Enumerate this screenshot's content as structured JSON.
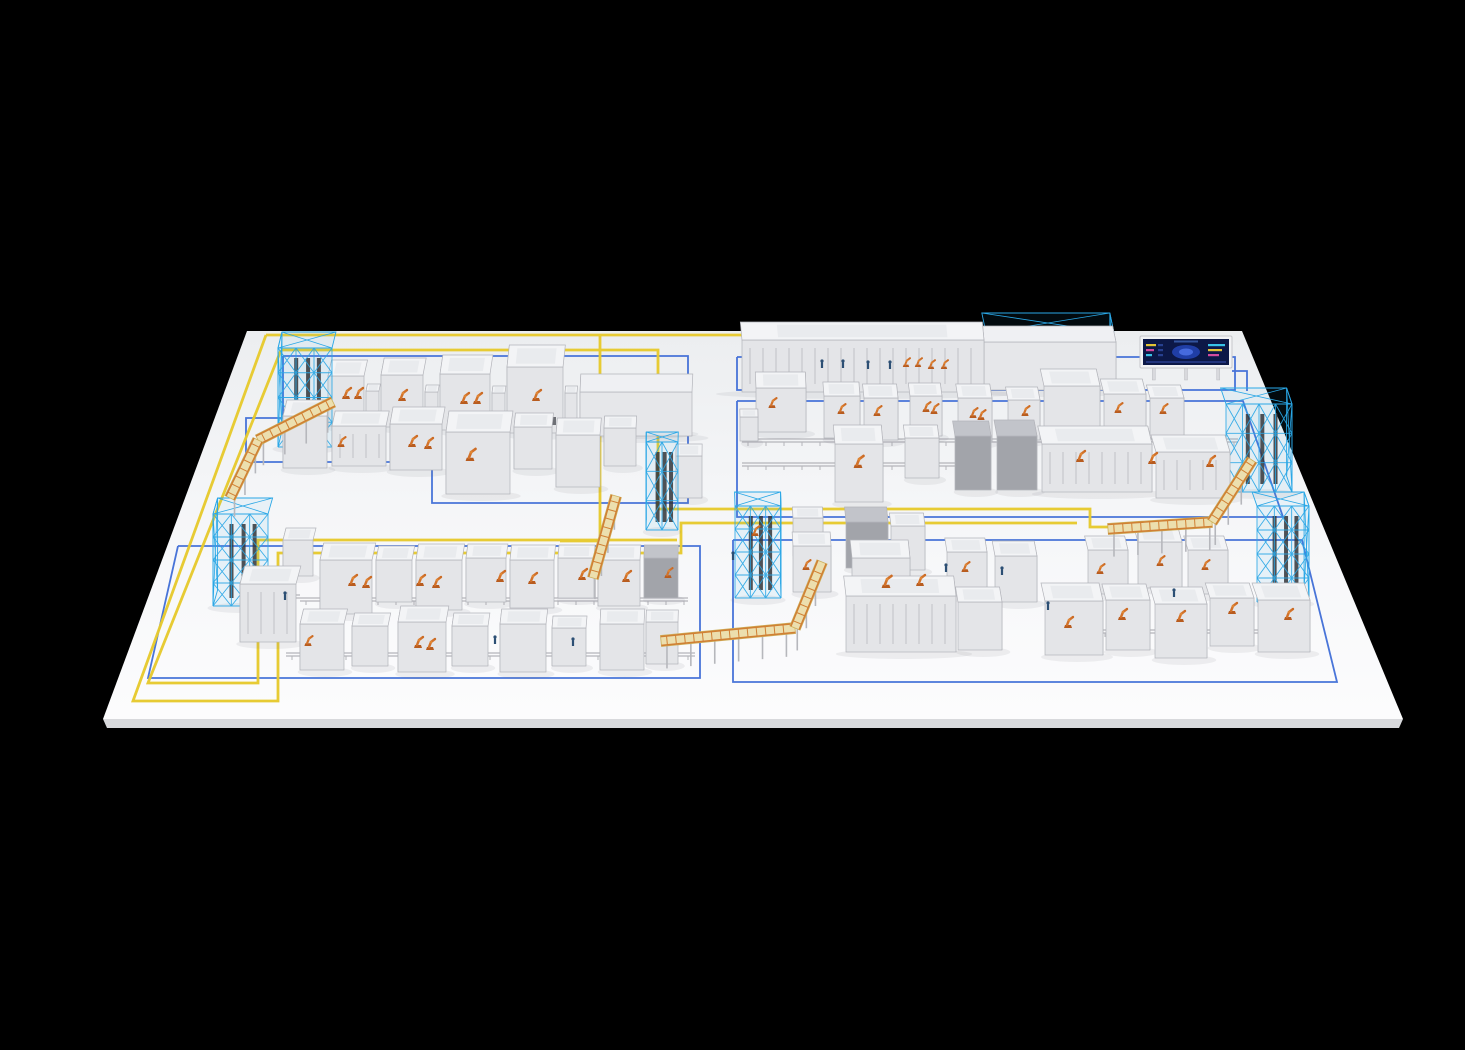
{
  "palette": {
    "background": "#000000",
    "floor_top": "#eceef0",
    "floor_mid": "#f5f6f8",
    "floor_bottom": "#fcfcfd",
    "floor_slab_edge": "#d8d9dc",
    "zone_line_blue": "#3a69d6",
    "route_line_yellow": "#e7ca2e",
    "rack_wireframe_blue": "#2aa7e6",
    "rack_core_dark": "#33353a",
    "robot_orange": "#d2722a",
    "robot_orange_dark": "#b85c1f",
    "worker_blue": "#2c4f74",
    "machine_top": "#f3f4f6",
    "machine_front": "#e4e5e8",
    "machine_side": "#cbccd1",
    "machine_stroke": "#b3b4ba",
    "machine_interior": "#e9ebee",
    "dark_top": "#c2c4ca",
    "dark_front": "#a2a4aa",
    "dark_side": "#8e9096",
    "vent_dark": "#6d6f75",
    "conveyor_deck": "#ecdfae",
    "conveyor_deck_edge": "#cdb05a",
    "conveyor_rail": "#d08034",
    "conveyor_leg": "#b6b7bc",
    "ground_rail": "#b4b5ba",
    "shadow": "rgba(120,122,128,0.10)",
    "dashboard_frame": "#f2f3f5",
    "dashboard_frame_stroke": "#c6c7cb",
    "dashboard_screen": "#0c1847",
    "dashboard_glow": "#2243b0",
    "dashboard_glow2": "#4a6fe3",
    "dashboard_bar1": "#e3c435",
    "dashboard_bar2": "#38c3e8",
    "dashboard_bar3": "#d24a9e"
  },
  "floor": {
    "corners": [
      [
        247,
        331
      ],
      [
        1242,
        331
      ],
      [
        1403,
        719
      ],
      [
        103,
        719
      ]
    ],
    "slab": [
      [
        103,
        719
      ],
      [
        1403,
        719
      ],
      [
        1399,
        728
      ],
      [
        107,
        728
      ]
    ]
  },
  "zones": [
    {
      "points": [
        [
          283,
          356
        ],
        [
          688,
          356
        ],
        [
          688,
          503
        ],
        [
          432,
          503
        ],
        [
          432,
          462
        ],
        [
          246,
          462
        ],
        [
          246,
          418
        ],
        [
          283,
          418
        ],
        [
          283,
          356
        ]
      ]
    },
    {
      "points": [
        [
          737,
          357
        ],
        [
          1235,
          357
        ],
        [
          1235,
          390
        ],
        [
          737,
          390
        ],
        [
          737,
          357
        ]
      ]
    },
    {
      "points": [
        [
          737,
          401
        ],
        [
          1243,
          401
        ],
        [
          1283,
          517
        ],
        [
          737,
          517
        ],
        [
          737,
          401
        ]
      ]
    },
    {
      "points": [
        [
          733,
          540
        ],
        [
          1302,
          540
        ],
        [
          1337,
          682
        ],
        [
          733,
          682
        ],
        [
          733,
          540
        ]
      ]
    },
    {
      "points": [
        [
          178,
          546
        ],
        [
          700,
          546
        ],
        [
          700,
          678
        ],
        [
          148,
          678
        ],
        [
          178,
          546
        ]
      ]
    }
  ],
  "zone_connector": [
    [
      1232,
      371
    ],
    [
      1247,
      371
    ],
    [
      1247,
      391
    ]
  ],
  "routes": [
    {
      "points": [
        [
          266,
          335
        ],
        [
          934,
          335
        ]
      ]
    },
    {
      "points": [
        [
          281,
          350
        ],
        [
          658,
          350
        ],
        [
          658,
          509
        ],
        [
          692,
          509
        ],
        [
          1090,
          509
        ],
        [
          1090,
          527
        ],
        [
          1205,
          527
        ]
      ]
    },
    {
      "points": [
        [
          600,
          335
        ],
        [
          600,
          541
        ],
        [
          560,
          541
        ]
      ]
    },
    {
      "points": [
        [
          266,
          335
        ],
        [
          133,
          701
        ],
        [
          278,
          701
        ],
        [
          278,
          553
        ],
        [
          681,
          553
        ],
        [
          681,
          523
        ],
        [
          1077,
          523
        ]
      ]
    },
    {
      "points": [
        [
          281,
          350
        ],
        [
          148,
          683
        ],
        [
          258,
          683
        ],
        [
          258,
          540
        ],
        [
          677,
          540
        ]
      ]
    }
  ],
  "ground_rails": [
    [
      742,
      441,
      1238,
      441
    ],
    [
      742,
      465,
      955,
      465
    ],
    [
      300,
      600,
      688,
      600
    ],
    [
      286,
      655,
      695,
      655
    ],
    [
      1045,
      632,
      1300,
      632
    ],
    [
      265,
      597,
      300,
      597
    ]
  ],
  "machines": [
    [
      328,
      426,
      36,
      50,
      16,
      0
    ],
    [
      366,
      419,
      13,
      28,
      7,
      0
    ],
    [
      381,
      427,
      42,
      52,
      17,
      0
    ],
    [
      425,
      420,
      13,
      28,
      7,
      0
    ],
    [
      440,
      430,
      50,
      56,
      19,
      0
    ],
    [
      492,
      423,
      13,
      30,
      7,
      0
    ],
    [
      507,
      433,
      56,
      66,
      22,
      3
    ],
    [
      565,
      423,
      12,
      30,
      7,
      0
    ],
    [
      580,
      436,
      112,
      44,
      18,
      4
    ],
    [
      283,
      468,
      44,
      52,
      16,
      0
    ],
    [
      332,
      466,
      54,
      40,
      15,
      2
    ],
    [
      390,
      470,
      52,
      46,
      17,
      0
    ],
    [
      446,
      494,
      64,
      62,
      21,
      0
    ],
    [
      514,
      469,
      38,
      42,
      14,
      0
    ],
    [
      556,
      487,
      44,
      52,
      17,
      0
    ],
    [
      604,
      466,
      32,
      38,
      12,
      0
    ],
    [
      676,
      498,
      26,
      42,
      12,
      0
    ],
    [
      742,
      392,
      242,
      52,
      18,
      2
    ],
    [
      984,
      390,
      132,
      48,
      16,
      4
    ],
    [
      756,
      432,
      50,
      44,
      16,
      0
    ],
    [
      740,
      441,
      18,
      24,
      8,
      0
    ],
    [
      824,
      438,
      36,
      42,
      14,
      0
    ],
    [
      864,
      440,
      34,
      42,
      14,
      0
    ],
    [
      910,
      436,
      32,
      40,
      13,
      0
    ],
    [
      958,
      442,
      34,
      44,
      14,
      0
    ],
    [
      1008,
      440,
      32,
      40,
      13,
      0
    ],
    [
      1044,
      432,
      56,
      46,
      17,
      0
    ],
    [
      1104,
      436,
      42,
      42,
      15,
      0
    ],
    [
      1150,
      438,
      34,
      40,
      13,
      0
    ],
    [
      835,
      502,
      48,
      58,
      19,
      0
    ],
    [
      905,
      478,
      34,
      40,
      13,
      0
    ],
    [
      955,
      490,
      36,
      54,
      15,
      1
    ],
    [
      997,
      490,
      40,
      54,
      16,
      1
    ],
    [
      1042,
      492,
      110,
      48,
      18,
      2
    ],
    [
      1156,
      498,
      74,
      46,
      17,
      2
    ],
    [
      846,
      568,
      42,
      46,
      15,
      1
    ],
    [
      891,
      570,
      34,
      44,
      13,
      0
    ],
    [
      852,
      612,
      58,
      54,
      18,
      0
    ],
    [
      846,
      652,
      110,
      56,
      20,
      2
    ],
    [
      958,
      650,
      44,
      48,
      15,
      0
    ],
    [
      793,
      556,
      30,
      38,
      11,
      0
    ],
    [
      793,
      592,
      38,
      46,
      14,
      0
    ],
    [
      947,
      596,
      40,
      44,
      14,
      0
    ],
    [
      995,
      602,
      42,
      46,
      15,
      0
    ],
    [
      1088,
      594,
      40,
      44,
      14,
      0
    ],
    [
      1138,
      588,
      44,
      46,
      15,
      0
    ],
    [
      1188,
      594,
      40,
      44,
      14,
      0
    ],
    [
      1045,
      655,
      58,
      54,
      18,
      0
    ],
    [
      1106,
      650,
      44,
      50,
      16,
      0
    ],
    [
      1155,
      658,
      52,
      54,
      17,
      0
    ],
    [
      1210,
      646,
      44,
      48,
      15,
      0
    ],
    [
      1258,
      652,
      52,
      52,
      17,
      0
    ],
    [
      283,
      576,
      30,
      36,
      12,
      0
    ],
    [
      240,
      642,
      56,
      58,
      18,
      2
    ],
    [
      320,
      614,
      52,
      54,
      17,
      0
    ],
    [
      376,
      602,
      36,
      42,
      14,
      0
    ],
    [
      416,
      610,
      46,
      50,
      16,
      0
    ],
    [
      466,
      602,
      40,
      44,
      14,
      0
    ],
    [
      510,
      608,
      44,
      48,
      15,
      0
    ],
    [
      558,
      598,
      36,
      40,
      13,
      0
    ],
    [
      598,
      606,
      42,
      46,
      15,
      0
    ],
    [
      644,
      598,
      34,
      40,
      13,
      1
    ],
    [
      300,
      670,
      44,
      46,
      15,
      0
    ],
    [
      352,
      666,
      36,
      40,
      13,
      0
    ],
    [
      398,
      672,
      48,
      50,
      16,
      0
    ],
    [
      452,
      666,
      36,
      40,
      13,
      0
    ],
    [
      500,
      672,
      46,
      48,
      15,
      0
    ],
    [
      552,
      666,
      34,
      38,
      12,
      0
    ],
    [
      600,
      670,
      44,
      46,
      15,
      0
    ],
    [
      646,
      664,
      32,
      42,
      12,
      0
    ]
  ],
  "racks": [
    [
      278,
      447,
      54,
      99,
      16,
      3,
      1
    ],
    [
      213,
      606,
      55,
      92,
      16,
      3,
      1
    ],
    [
      986,
      383,
      128,
      50,
      20,
      7,
      0
    ],
    [
      1226,
      492,
      66,
      88,
      16,
      4,
      1
    ],
    [
      735,
      598,
      46,
      92,
      14,
      3,
      1
    ],
    [
      1257,
      602,
      52,
      96,
      14,
      3,
      1
    ],
    [
      584,
      432,
      104,
      42,
      14,
      6,
      0
    ],
    [
      646,
      530,
      32,
      88,
      10,
      2,
      1
    ]
  ],
  "conveyors": [
    {
      "segs": [
        [
          333,
          402,
          258,
          440
        ],
        [
          258,
          440,
          230,
          498
        ]
      ]
    },
    {
      "segs": [
        [
          616,
          496,
          593,
          578
        ]
      ]
    },
    {
      "segs": [
        [
          661,
          641,
          795,
          628
        ],
        [
          795,
          628,
          822,
          562
        ]
      ]
    },
    {
      "segs": [
        [
          1108,
          529,
          1212,
          522
        ],
        [
          1212,
          522,
          1252,
          460
        ]
      ]
    }
  ],
  "robots": [
    [
      346,
      399,
      1
    ],
    [
      358,
      399,
      1
    ],
    [
      402,
      401,
      1
    ],
    [
      464,
      404,
      1
    ],
    [
      477,
      404,
      1
    ],
    [
      536,
      401,
      1
    ],
    [
      412,
      447,
      1
    ],
    [
      428,
      449,
      1
    ],
    [
      470,
      461,
      1.1
    ],
    [
      341,
      447,
      0.9
    ],
    [
      906,
      367,
      0.8
    ],
    [
      918,
      367,
      0.8
    ],
    [
      931,
      369,
      0.8
    ],
    [
      944,
      369,
      0.8
    ],
    [
      841,
      414,
      0.9
    ],
    [
      877,
      416,
      0.9
    ],
    [
      926,
      412,
      0.9
    ],
    [
      934,
      414,
      0.9
    ],
    [
      973,
      418,
      0.9
    ],
    [
      981,
      420,
      0.9
    ],
    [
      1025,
      416,
      0.9
    ],
    [
      1118,
      413,
      0.9
    ],
    [
      1163,
      414,
      0.9
    ],
    [
      772,
      408,
      0.9
    ],
    [
      858,
      468,
      1.1
    ],
    [
      1080,
      462,
      1
    ],
    [
      1152,
      464,
      1
    ],
    [
      1210,
      467,
      1
    ],
    [
      886,
      588,
      1.1
    ],
    [
      920,
      586,
      1
    ],
    [
      806,
      570,
      0.9
    ],
    [
      755,
      536,
      0.9
    ],
    [
      1068,
      628,
      1
    ],
    [
      1122,
      620,
      1
    ],
    [
      1180,
      622,
      1
    ],
    [
      1232,
      614,
      1
    ],
    [
      1288,
      620,
      1
    ],
    [
      1100,
      574,
      0.9
    ],
    [
      1160,
      566,
      0.9
    ],
    [
      1205,
      570,
      0.9
    ],
    [
      965,
      572,
      0.9
    ],
    [
      352,
      586,
      1
    ],
    [
      366,
      588,
      1
    ],
    [
      420,
      586,
      1
    ],
    [
      436,
      588,
      1
    ],
    [
      500,
      582,
      1
    ],
    [
      532,
      584,
      1
    ],
    [
      582,
      580,
      1
    ],
    [
      626,
      582,
      1
    ],
    [
      668,
      578,
      0.9
    ],
    [
      418,
      648,
      1
    ],
    [
      430,
      650,
      1
    ],
    [
      308,
      646,
      0.9
    ]
  ],
  "workers": [
    [
      822,
      368
    ],
    [
      843,
      368
    ],
    [
      868,
      369
    ],
    [
      890,
      369
    ],
    [
      946,
      572
    ],
    [
      1002,
      575
    ],
    [
      1174,
      597
    ],
    [
      495,
      644
    ],
    [
      573,
      646
    ],
    [
      285,
      600
    ],
    [
      733,
      560
    ],
    [
      1048,
      610
    ]
  ],
  "dashboard": {
    "x": 1140,
    "y": 336,
    "w": 92,
    "h": 32,
    "legH": 12
  }
}
